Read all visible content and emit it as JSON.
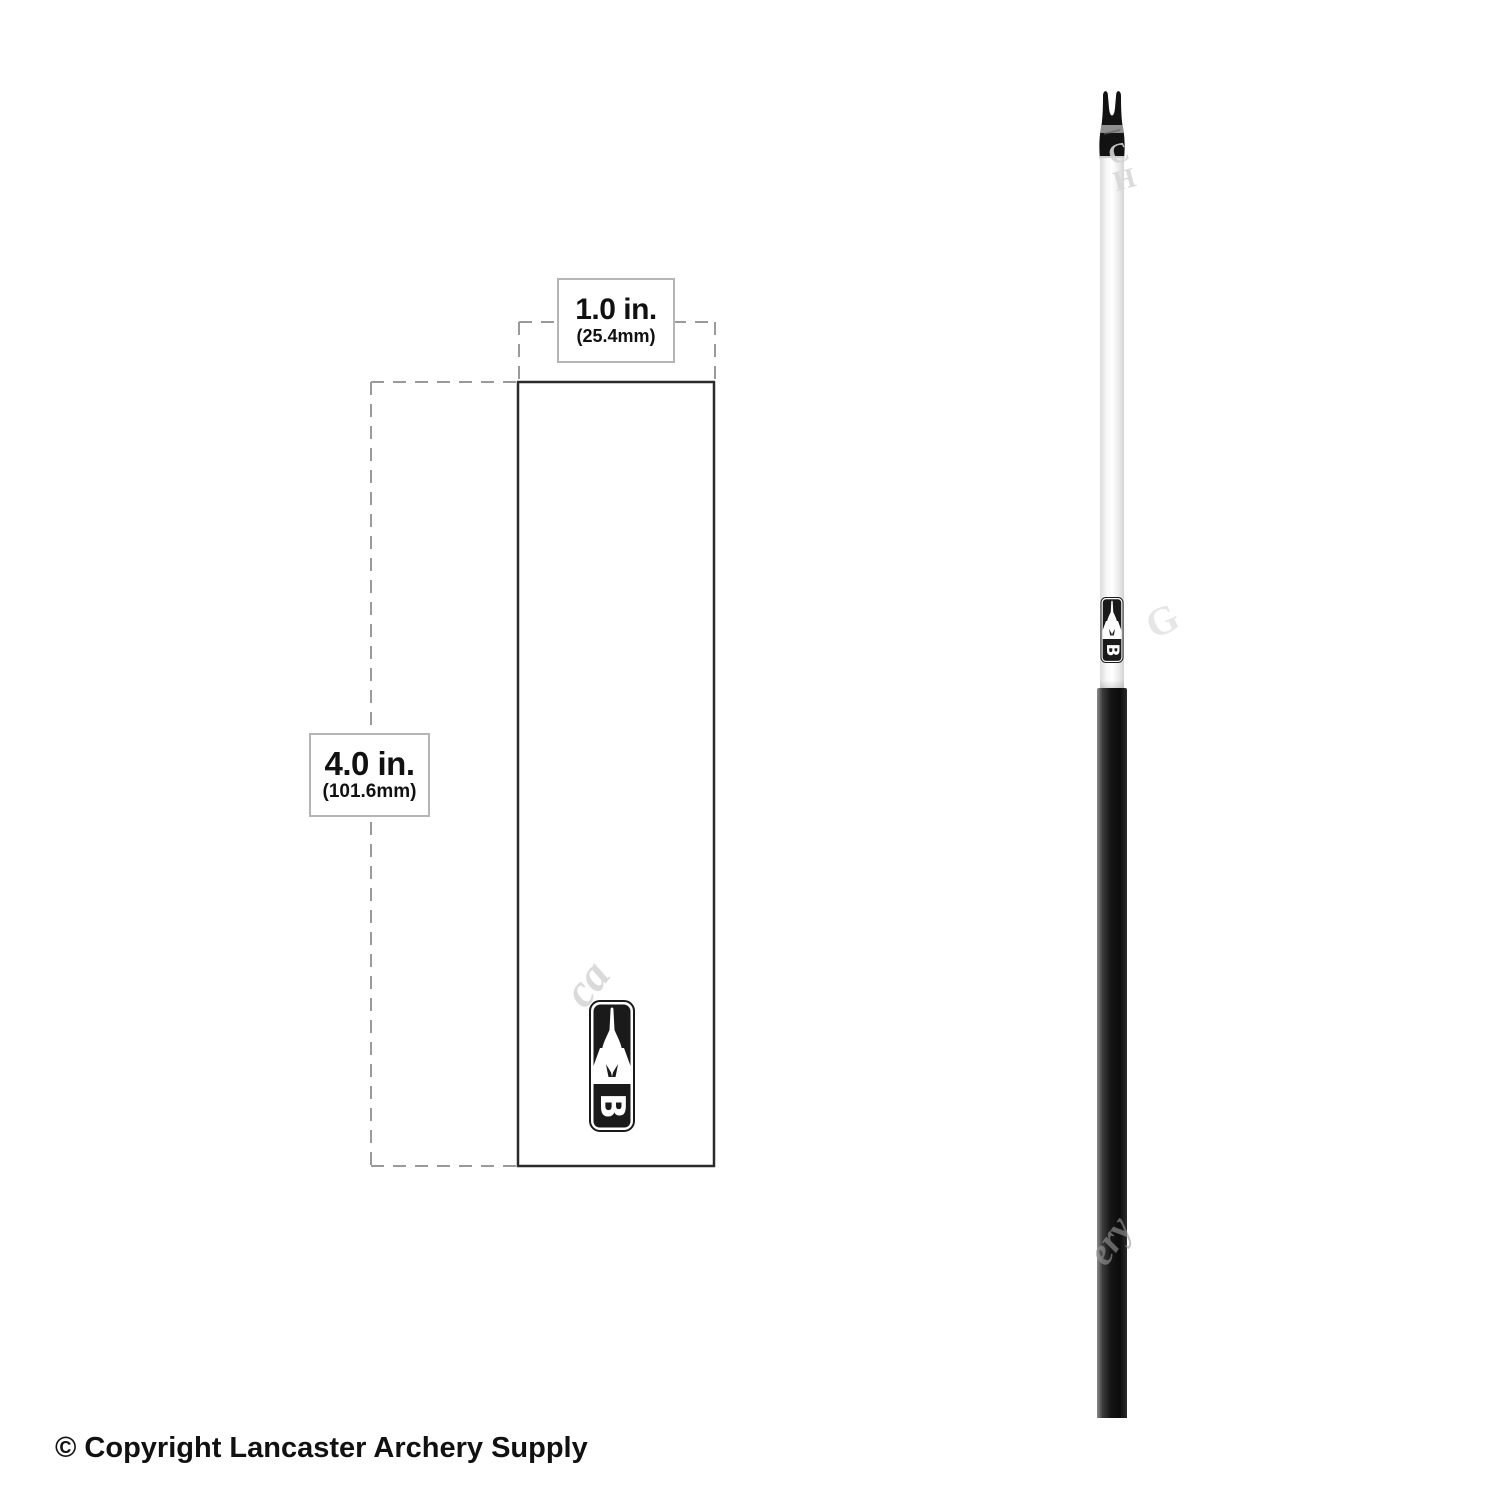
{
  "dimension_diagram": {
    "width_label": {
      "primary": "1.0 in.",
      "secondary": "(25.4mm)"
    },
    "height_label": {
      "primary": "4.0 in.",
      "secondary": "(101.6mm)"
    }
  },
  "brand": {
    "logo_letter": "B"
  },
  "footer": {
    "copyright_text": "© Copyright Lancaster Archery Supply"
  },
  "watermark": {
    "fragments": [
      {
        "text": "C",
        "x": 1104,
        "y": 143,
        "size": 28,
        "rot": -20,
        "color": "#d3d3d3",
        "opacity": 0.9,
        "italic": false
      },
      {
        "text": "H",
        "x": 1110,
        "y": 168,
        "size": 28,
        "rot": -15,
        "color": "#d8d8d8",
        "opacity": 0.9,
        "italic": false
      },
      {
        "text": "ca",
        "x": 552,
        "y": 984,
        "size": 46,
        "rot": -52,
        "color": "#bdbdbd",
        "opacity": 0.55,
        "italic": true
      },
      {
        "text": "G",
        "x": 1138,
        "y": 606,
        "size": 40,
        "rot": -25,
        "color": "#e2e2e2",
        "opacity": 0.85,
        "italic": false
      },
      {
        "text": "ery",
        "x": 1078,
        "y": 1248,
        "size": 38,
        "rot": -55,
        "color": "#9b9b9b",
        "opacity": 0.6,
        "italic": true
      }
    ]
  },
  "colors": {
    "dashed_line": "#9a9a9a",
    "solid_outline": "#2b2b2b",
    "label_border": "#b5b5b5",
    "text": "#111111",
    "nock_black": "#121212",
    "shaft_black": "#141414"
  }
}
